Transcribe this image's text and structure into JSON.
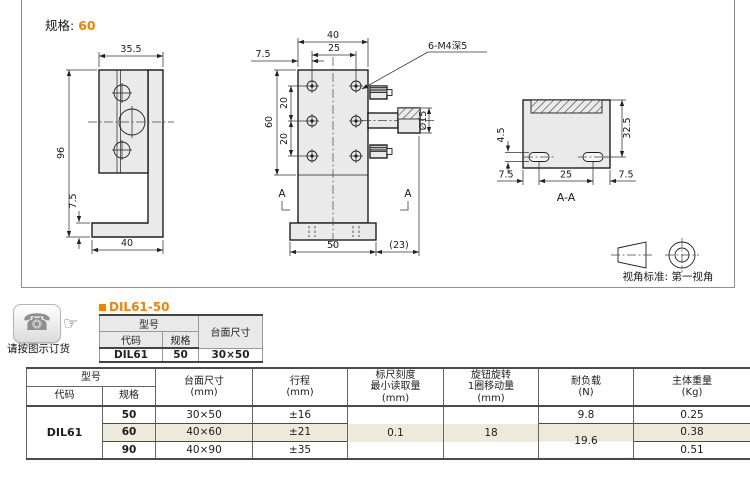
{
  "colors": {
    "accent": "#F08300",
    "row_highlight": "#EEEADB",
    "header_bg": "#E9E9E9"
  },
  "header": {
    "spec_label": "规格:",
    "spec_value": "60"
  },
  "drawings": {
    "side_view": {
      "width": "35.5",
      "height": "96",
      "foot_height": "7.5",
      "base_width": "40"
    },
    "front_view": {
      "top_width": "40",
      "hole_offset": "7.5",
      "hole_span": "25",
      "thread_note": "6-M4深5",
      "side_height": "60",
      "pitch_top": "20",
      "pitch_bottom": "20",
      "knob_dia": "Ø15",
      "section_left": "A",
      "section_right": "A",
      "base_width": "50",
      "knob_overhang": "(23)"
    },
    "section_view": {
      "slot_height": "4.5",
      "depth": "32.5",
      "edge_left": "7.5",
      "slot_span": "25",
      "edge_right": "7.5",
      "title": "A-A"
    },
    "projection_note": "视角标准: 第一视角"
  },
  "order_note": {
    "phone_icon": "phone-icon",
    "hand_icon": "pointing-hand-icon",
    "text": "请按图示订货"
  },
  "part_table": {
    "title": "DIL61-50",
    "header_model": "型号",
    "header_code": "代码",
    "header_spec": "规格",
    "header_size": "台面尺寸",
    "code": "DIL61",
    "spec": "50",
    "size": "30×50"
  },
  "spec_table": {
    "header": {
      "model": "型号",
      "code": "代码",
      "spec": "规格",
      "size_1": "台面尺寸",
      "size_2": "(mm)",
      "stroke_1": "行程",
      "stroke_2": "(mm)",
      "scale_1": "标尺刻度",
      "scale_2": "最小读取量",
      "scale_3": "(mm)",
      "knob_1": "旋钮旋转",
      "knob_2": "1圈移动量",
      "knob_3": "(mm)",
      "load_1": "耐负载",
      "load_2": "(N)",
      "weight_1": "主体重量",
      "weight_2": "(Kg)"
    },
    "code": "DIL61",
    "rows": [
      {
        "spec": "50",
        "size": "30×50",
        "stroke": "±16",
        "weight": "0.25"
      },
      {
        "spec": "60",
        "size": "40×60",
        "stroke": "±21",
        "weight": "0.38"
      },
      {
        "spec": "90",
        "size": "40×90",
        "stroke": "±35",
        "weight": "0.51"
      }
    ],
    "scale_min": "0.1",
    "knob_move": "18",
    "load_row1": "9.8",
    "load_rows23": "19.6"
  }
}
